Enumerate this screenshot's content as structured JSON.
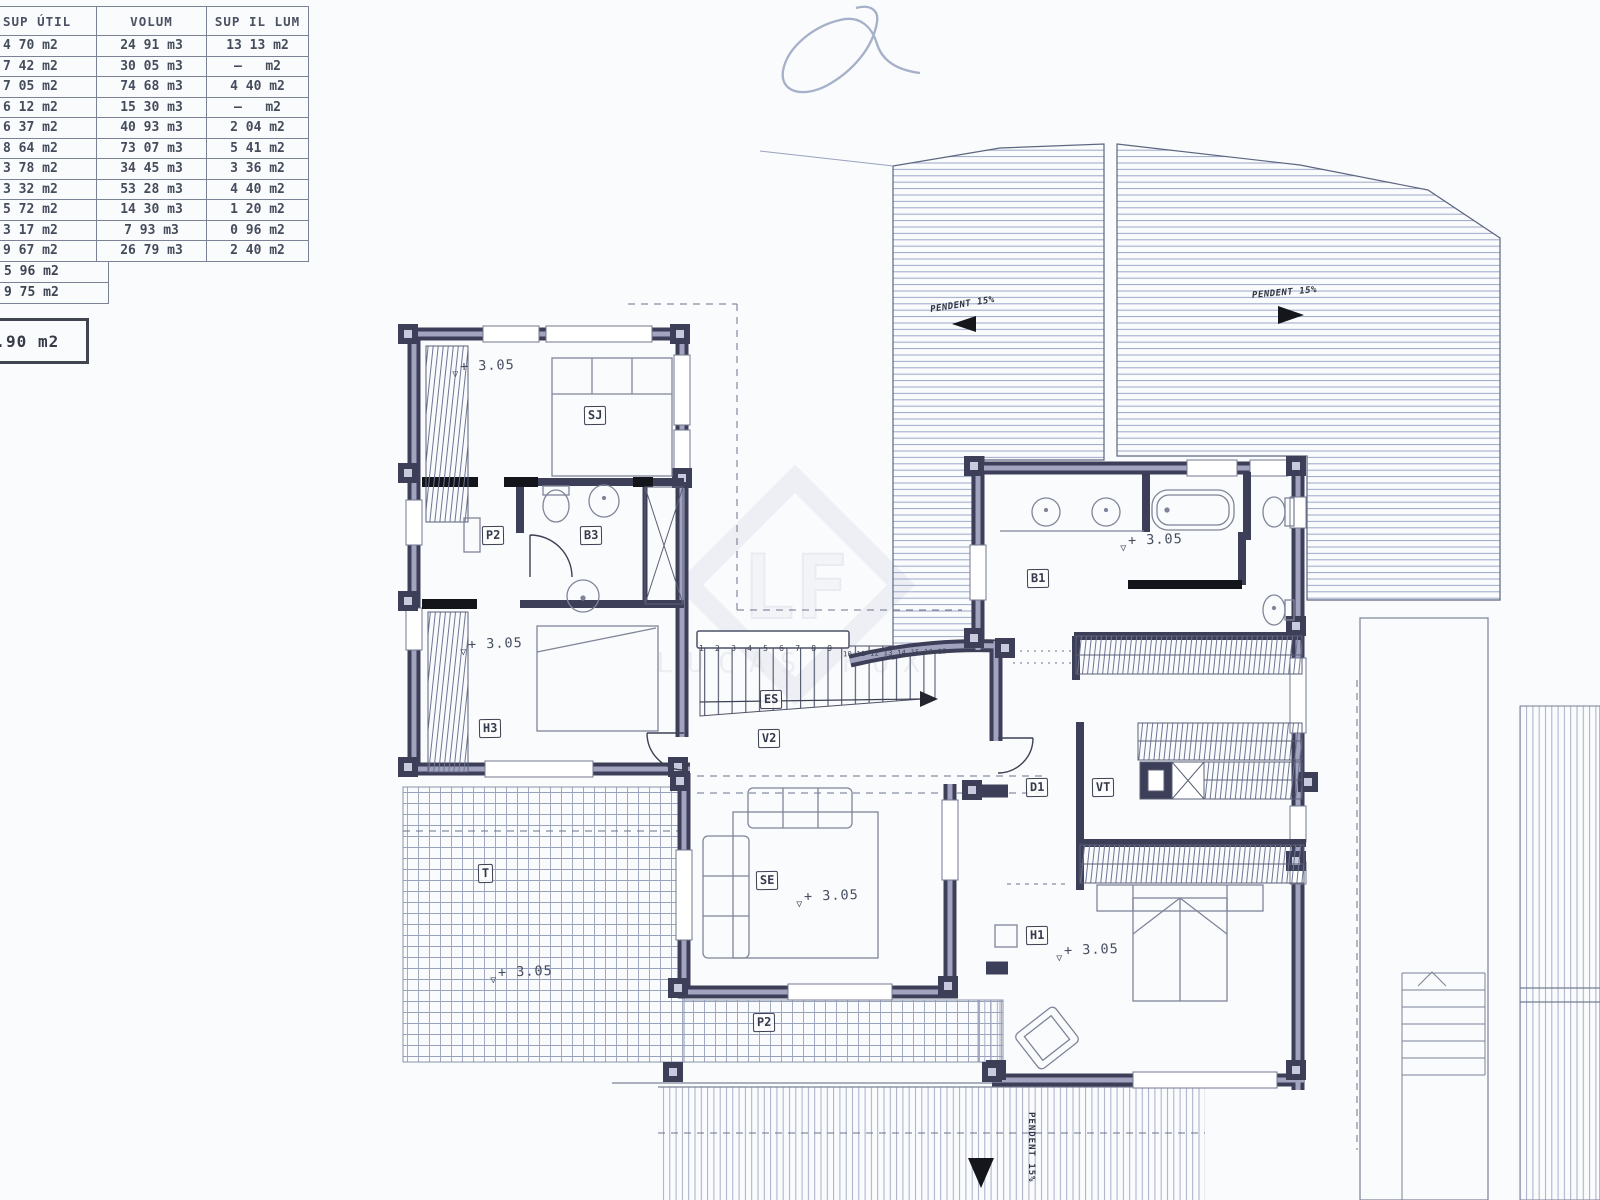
{
  "table": {
    "headers": [
      "SUP ÚTIL",
      "VOLUM",
      "SUP IL LUM"
    ],
    "rows": [
      [
        "4 70 m2",
        "24 91 m3",
        "13 13 m2"
      ],
      [
        "7 42 m2",
        "30 05 m3",
        "—   m2"
      ],
      [
        "7 05 m2",
        "74 68 m3",
        "4 40 m2"
      ],
      [
        "6 12 m2",
        "15 30 m3",
        "—   m2"
      ],
      [
        "6 37 m2",
        "40 93 m3",
        "2 04 m2"
      ],
      [
        "8 64 m2",
        "73 07 m3",
        "5 41 m2"
      ],
      [
        "3 78 m2",
        "34 45 m3",
        "3 36 m2"
      ],
      [
        "3 32 m2",
        "53 28 m3",
        "4 40 m2"
      ],
      [
        "5 72 m2",
        "14 30 m3",
        "1 20 m2"
      ],
      [
        "3 17 m2",
        "7 93 m3",
        "0 96 m2"
      ],
      [
        "9 67 m2",
        "26 79 m3",
        "2 40 m2"
      ]
    ],
    "extra_rows": [
      "5 96 m2",
      "9 75 m2"
    ],
    "total": "6.90 m2"
  },
  "plan": {
    "room_labels": [
      "SJ",
      "P2",
      "B3",
      "H3",
      "ES",
      "V2",
      "SE",
      "B1",
      "D1",
      "VT",
      "H1",
      "T",
      "P2"
    ],
    "elevation": "+ 3.05",
    "slope_left": "PENDENT 15%",
    "slope_right": "PENDENT 15%",
    "slope_bottom": "PENDENT 15%",
    "stairs_numbers_low": "1 2 3 4 5 6 7 8 9",
    "stairs_numbers_high": "10 11 12 13 14 15 16 17"
  },
  "watermark": {
    "initials": "LF",
    "name": "LUCAS FOX"
  },
  "colors": {
    "wall": "#3d3e58",
    "hatch": "#9ba7c6",
    "black": "#15161c"
  }
}
